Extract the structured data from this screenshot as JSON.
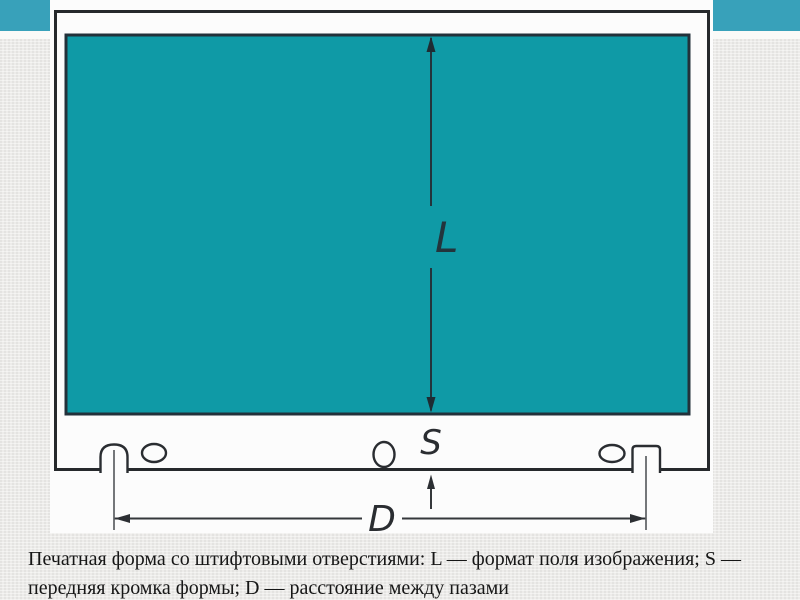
{
  "diagram": {
    "label_L": "L",
    "label_S": "S",
    "label_D": "D"
  },
  "caption": {
    "line1": "Печатная форма со штифтовыми отверстиями: L — формат поля изображения; S —",
    "line2": "передняя кромка формы; D — расстояние между пазами"
  },
  "colors": {
    "accent_bar": "#38a1ba",
    "image_area": "#0f9aa6",
    "plate_outline": "#26292c",
    "figure_background": "#fcfcfc",
    "slide_background": "#edecea"
  }
}
